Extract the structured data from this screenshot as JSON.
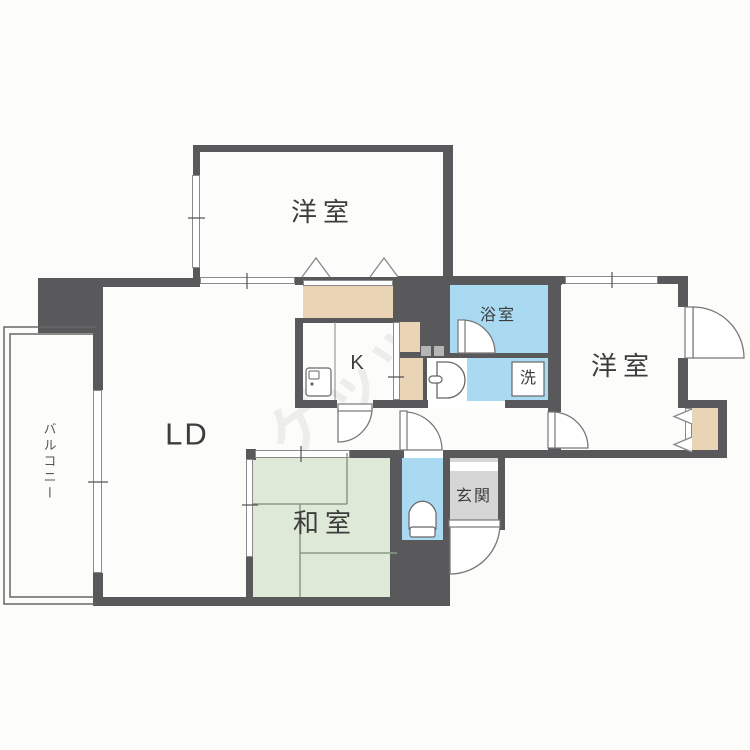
{
  "plan": {
    "title": "apartment-floor-plan",
    "rooms": {
      "western_room_top": {
        "label": "洋室"
      },
      "western_room_right": {
        "label": "洋室"
      },
      "living_dining": {
        "label": "LD"
      },
      "kitchen": {
        "label": "K"
      },
      "japanese_room": {
        "label": "和室"
      },
      "bathroom": {
        "label": "浴室"
      },
      "laundry": {
        "label": "洗"
      },
      "entrance": {
        "label": "玄関"
      },
      "balcony": {
        "label": "バルコニー"
      }
    },
    "watermark": "ゲッツ",
    "colors": {
      "wall": "#59595b",
      "water_blue": "#a9daf2",
      "tatami_green": "#dfe9d8",
      "closet_beige": "#e9d4b5",
      "entrance_gray": "#d6d6d6",
      "line": "#777777",
      "text": "#3c3c3c",
      "background": "#fcfcfa",
      "watermark_gray": "#e4e4e4"
    }
  }
}
